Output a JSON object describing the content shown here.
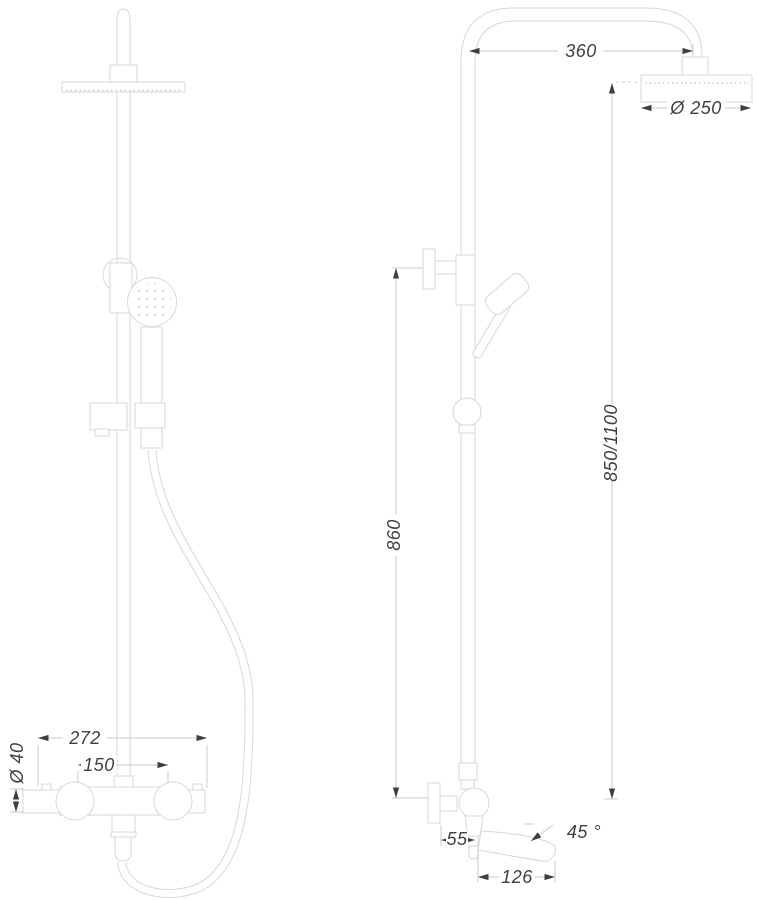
{
  "drawing": {
    "description": "Thermostatic shower column, two-view dimensioned technical drawing",
    "colors": {
      "background": "#ffffff",
      "geometry_line": "#d6d9d9",
      "dimension_line": "#c4c8c8",
      "ink": "#3d4040"
    },
    "front_view": {
      "overall_width": "272",
      "port_spacing": "150",
      "body_diameter": "Ø 40"
    },
    "side_view": {
      "arm_reach": "360",
      "head_diameter": "Ø 250",
      "riser_height": "850/1100",
      "bracket_height": "860",
      "spout_wall_offset": "55",
      "spout_angle": "45 °",
      "spout_length": "126"
    }
  }
}
